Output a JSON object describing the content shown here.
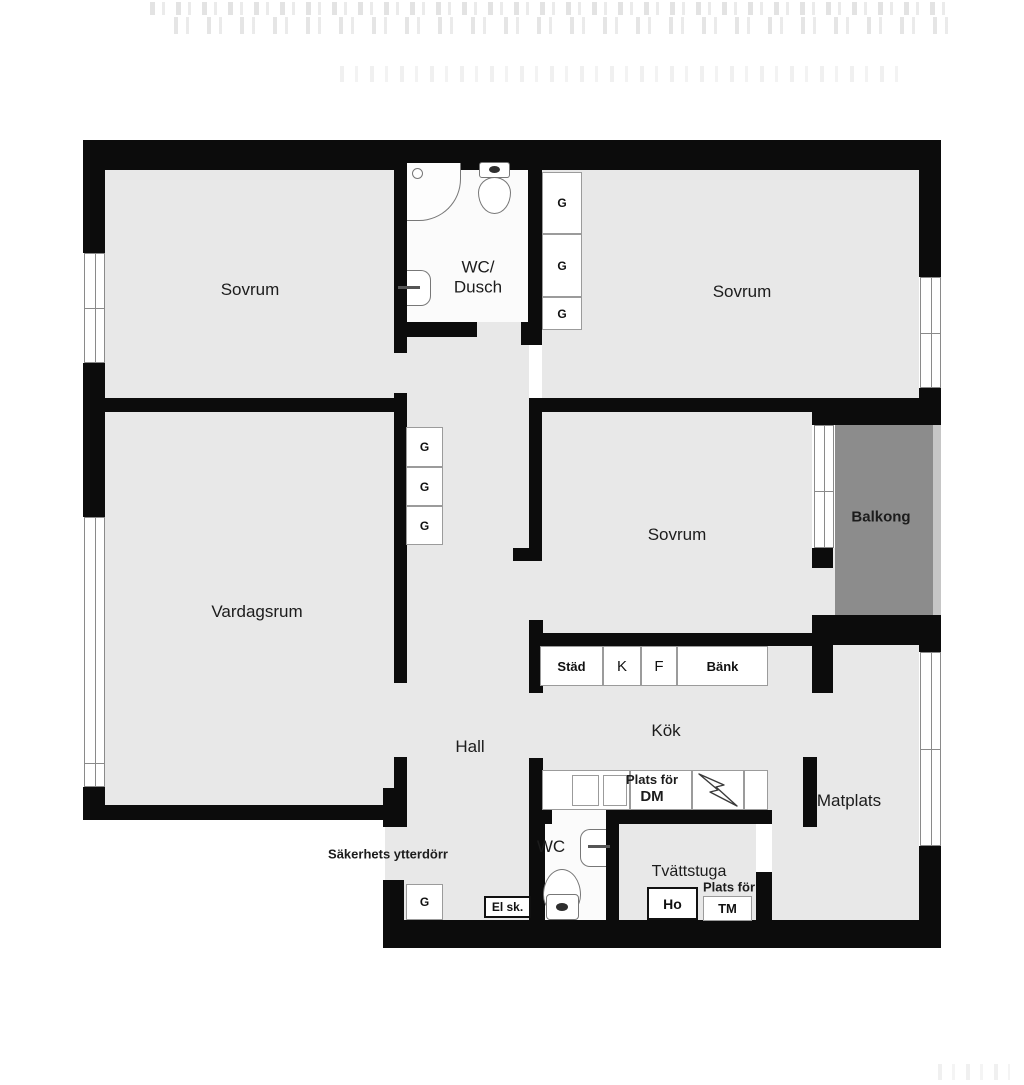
{
  "colors": {
    "wall": "#0c0c0c",
    "floor": "#e8e8e8",
    "bathroom_floor": "#fbfbfb",
    "balcony": "#8c8c8c",
    "balcony_edge": "#c6c6c6",
    "window_line": "#8a8a8a",
    "text": "#1c1c1c"
  },
  "rooms": {
    "sovrum_top_left": "Sovrum",
    "sovrum_top_right": "Sovrum",
    "sovrum_middle": "Sovrum",
    "vardagsrum": "Vardagsrum",
    "wc_dusch_line1": "WC/",
    "wc_dusch_line2": "Dusch",
    "hall": "Hall",
    "kok": "Kök",
    "matplats": "Matplats",
    "balkong": "Balkong",
    "wc": "WC",
    "tvattstuga": "Tvättstuga"
  },
  "kitchen": {
    "cabinets": [
      "Städ",
      "K",
      "F",
      "Bänk"
    ],
    "dm_line1": "Plats för",
    "dm_line2": "DM",
    "ho": "Ho",
    "tm_line1": "Plats för",
    "tm_line2": "TM"
  },
  "labels": {
    "wardrobe": "G",
    "electrical_cabinet": "El sk.",
    "entrance_door": "Säkerhets ytterdörr"
  }
}
